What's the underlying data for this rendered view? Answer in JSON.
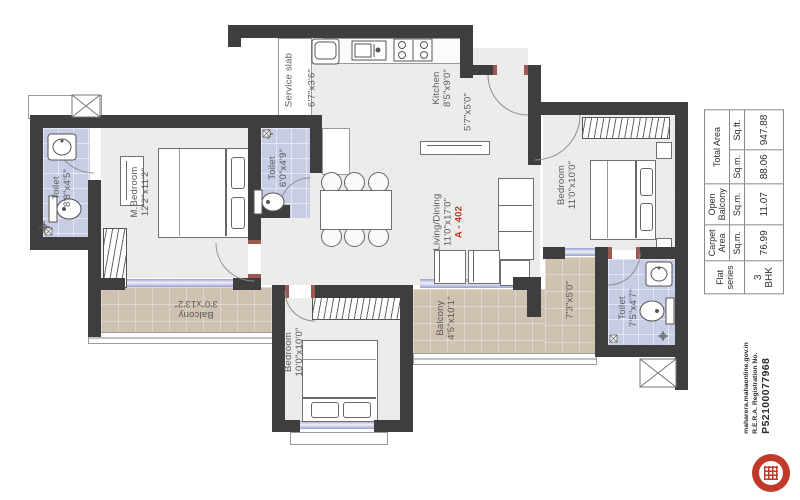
{
  "plan": {
    "flat_no": "A - 402",
    "rooms": [
      {
        "id": "toilet-top-left",
        "label": "Toilet",
        "dim": "8'8\"x4'5\""
      },
      {
        "id": "m-bedroom",
        "label": "M.Bedroom",
        "dim": "12'2\"x11'2\""
      },
      {
        "id": "service-slab",
        "label": "Service slab",
        "dim": "6'7\"x3'6\""
      },
      {
        "id": "toilet-mid",
        "label": "Toilet",
        "dim": "6'0\"x4'9\""
      },
      {
        "id": "kitchen",
        "label": "Kitchen",
        "dim": "8'5\"x9'0\""
      },
      {
        "id": "foyer",
        "label": "",
        "dim": "5'7\"x5'0\""
      },
      {
        "id": "living-dining",
        "label": "Living/Dining",
        "dim": "11'0\"x17'0\""
      },
      {
        "id": "bedroom-right",
        "label": "Bedroom",
        "dim": "11'0\"x10'0\""
      },
      {
        "id": "toilet-bottom-right",
        "label": "Toilet",
        "dim": "7'5\"x4'7\""
      },
      {
        "id": "balcony-right",
        "label": "",
        "dim": "7'3\"x5'0\""
      },
      {
        "id": "balcony-bottom",
        "label": "Balcony",
        "dim": "4'5\"x10'1\""
      },
      {
        "id": "bedroom-bottom",
        "label": "Bedroom",
        "dim": "10'0\"x10'0\""
      },
      {
        "id": "balcony-left",
        "label": "Balcony",
        "dim": "3'0\"x13'2\""
      }
    ]
  },
  "area_table": {
    "flat_series_header": "Flat series",
    "carpet_header": "Carpet Area",
    "open_balcony_header": "Open Balcony",
    "total_header": "Total Area",
    "sqm": "Sq.m.",
    "sqft": "Sq.ft.",
    "flat_series": "3 BHK",
    "carpet_sqm": "76.99",
    "open_balcony_sqm": "11.07",
    "total_sqm": "88.06",
    "total_sqft": "947.88"
  },
  "rera": {
    "website": "maharera.mahaonline.gov.in",
    "reg_label": "R.E.R.A. Registration No.",
    "reg_no": "P52100077968"
  },
  "colors": {
    "wall": "#3e3e3e",
    "toilet_floor": "#c6cde4",
    "balcony_floor": "#cfc2b0",
    "room_floor": "#ececea",
    "window": "#99a1ce",
    "accent_red": "#c13428",
    "stamp_red": "#c0392b"
  }
}
